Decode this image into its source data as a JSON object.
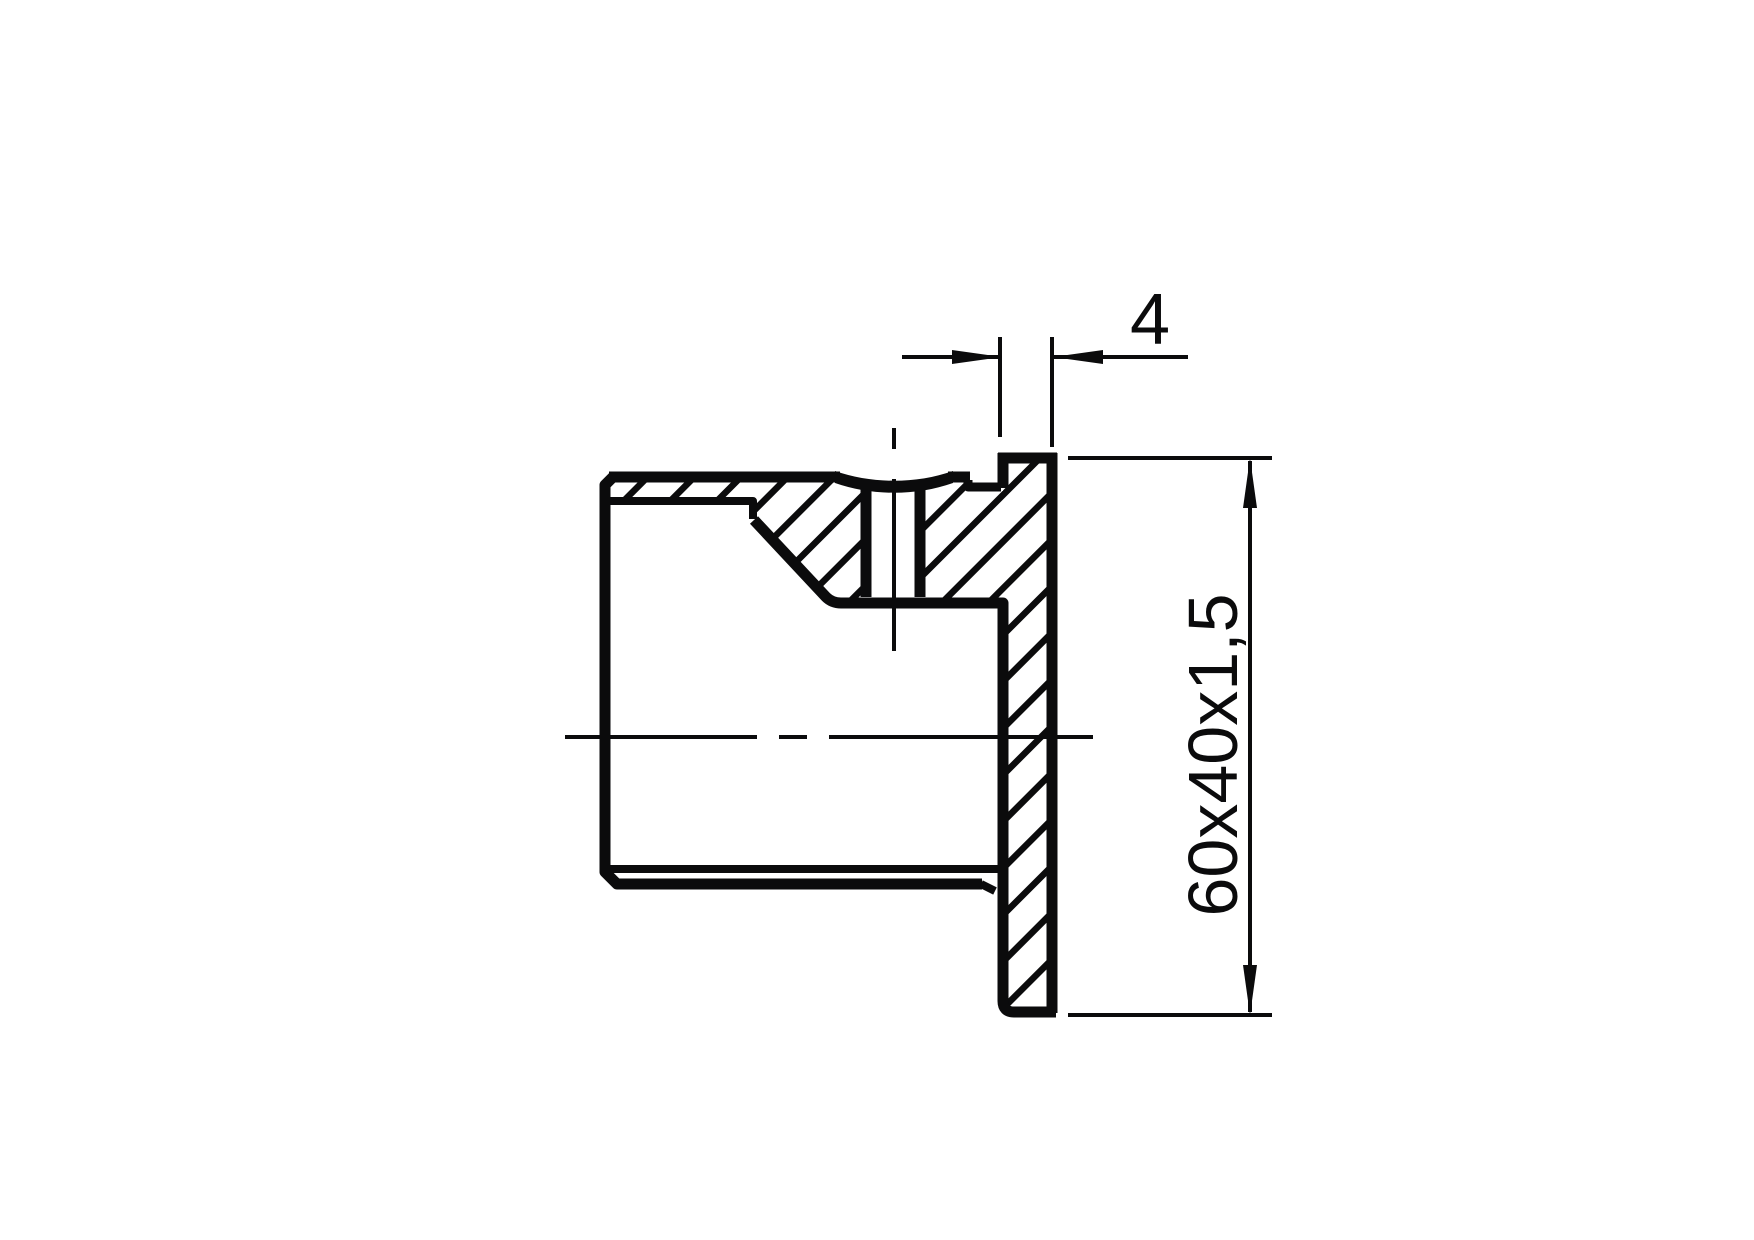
{
  "canvas": {
    "background": "#ffffff",
    "ink": "#0b0b0c"
  },
  "dimensions": {
    "flange_thickness": {
      "label": "4"
    },
    "profile_size": {
      "label": "60x40x1,5"
    }
  }
}
